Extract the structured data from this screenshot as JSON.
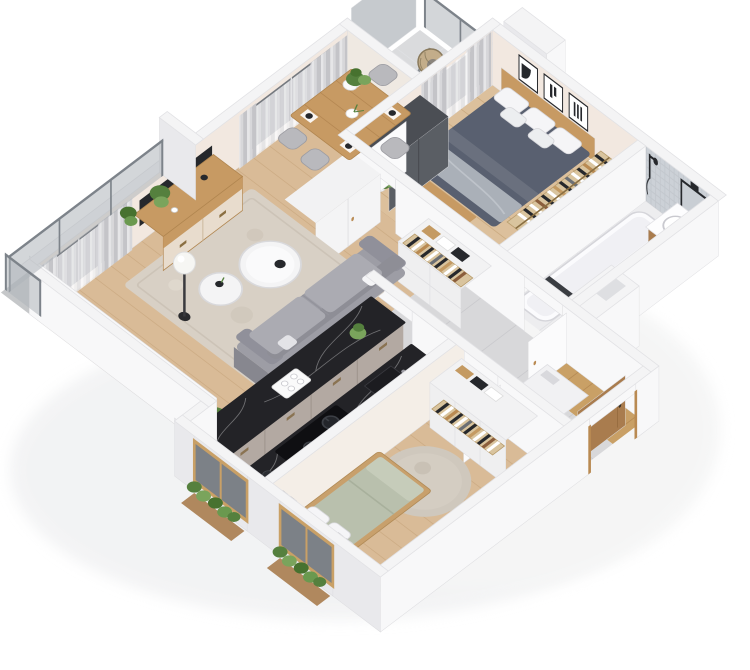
{
  "scene": {
    "type": "isometric-3d-floor-plan",
    "description": "3D isometric cutaway render of a two-bedroom apartment with open living/dining room, galley kitchen, two bedrooms, bathroom, hallway with storage, laundry nook, entry and two balconies",
    "background": "#ffffff"
  },
  "palette": {
    "background": "#ffffff",
    "wallTop": "#f4f4f5",
    "wallBright": "#f8f8f9",
    "wallShade": "#e9e9ec",
    "wallCream": "#f2e8e0",
    "wallCream2": "#f4eee7",
    "woodFloor": "#d9bb97",
    "woodFloor2": "#dcc09c",
    "tileFloor": "#d8d8da",
    "bathFloor": "#ededef",
    "balconyFloor": "#c5c7c9",
    "recessFloor": "#dadbdd",
    "entryWood": "#c9a066",
    "rugBeige": "#d8d0c5",
    "rugRound": "#cfc8bd",
    "marbleTop": "#232327",
    "cabinetFront": "#b3a9a2",
    "cabinetEnd": "#a69c95",
    "woodFurniture": "#c79a63",
    "sideboardFront": "#e8dccd",
    "sofaGray": "#9d9da5",
    "sofaBack": "#8e8e96",
    "sofaCushion": "#ababb2",
    "sofaFront": "#87878f",
    "bedDuvetDark": "#596070",
    "throwGray": "#aab0b8",
    "bedDuvetSage": "#b9c0ad",
    "pillowWhite": "#f5f5f7",
    "mosaicTile": "#ccd1d7",
    "plantDark": "#55803e",
    "plantLight": "#7aa45c",
    "potWhite": "#fafafa",
    "curtainGray": "#c9c9cd",
    "curtainSheer": "#ececee",
    "windowGlass": "#75797f",
    "frameBlack": "#26282c",
    "mirrorGlass": "#c9ced4",
    "applianceWhite": "#f7f7f9",
    "applianceDark": "#2e2e33",
    "glassRailing": "#aeb4ba",
    "doorLeaf": "#fbfbfc",
    "doorWood": "#a97c4e",
    "wardrobeDark": "#5a5e64",
    "wardrobeDarkTop": "#4b4e54",
    "closetWhite": "#f2f2f3",
    "cooktopBlack": "#0f0f12",
    "railWood": "#d9c49e",
    "hangerChair": "#c3ad8a"
  },
  "rooms": {
    "living_dining": {
      "label": "Living and dining room",
      "floor": "wood planks",
      "items": [
        "curtained windows",
        "sheer and gray drapes",
        "wall clock",
        "flat TV leaning on wall",
        "wooden sideboard with white drawers",
        "dining table",
        "four gray dining chairs",
        "place settings with dark plates",
        "white vase with flowers",
        "potted plant",
        "speckled beige area rug",
        "two round white coffee tables",
        "black decor bowl",
        "white globe floor lamp",
        "gray sofa with white throw pillows",
        "green floor plant"
      ]
    },
    "bedroom_1": {
      "label": "Main bedroom",
      "floor": "wood planks",
      "items": [
        "double bed with dark slate duvet",
        "white pillows",
        "gray throw blanket",
        "wooden headboard and foot bench",
        "three black-framed artworks",
        "open clothes rack with hangers",
        "dark gray wardrobe",
        "window to loggia with curtains",
        "potted plant",
        "white door leaf"
      ]
    },
    "bathroom": {
      "label": "Bathroom",
      "floor": "white stone tiles",
      "items": [
        "long bathtub",
        "black shower fixture",
        "gray mosaic tiled walls",
        "black framed mirror",
        "wall lamp",
        "wooden vanity with round washbasin",
        "dark towel",
        "open white door"
      ]
    },
    "hallway": {
      "label": "Hallway",
      "floor": "large gray tiles",
      "items": [
        "white storage cabinet",
        "closet with folded clothes",
        "open hanger rail with clothes",
        "doorways to rooms"
      ]
    },
    "entry": {
      "label": "Entry",
      "floor": "wood",
      "items": [
        "open wooden entry door",
        "floor niche"
      ]
    },
    "utility": {
      "label": "Laundry nook",
      "items": [
        "front-load washing machine",
        "white cabinets"
      ]
    },
    "kitchen": {
      "label": "Kitchen",
      "floor": "large light tiles",
      "items": [
        "peninsula counter with black marble top",
        "taupe drawer fronts",
        "second counter with black marble top",
        "black cooktop with two pots",
        "inset sink",
        "small green plant",
        "white cups and tray",
        "wooden window with planter"
      ]
    },
    "bedroom_2": {
      "label": "Second bedroom",
      "floor": "wood planks",
      "items": [
        "single bed with sage duvet",
        "white pillows",
        "wooden bed frame",
        "wardrobe with hanger rail and clothes",
        "round beige rug",
        "wooden window with curtains",
        "potted plant"
      ]
    },
    "balcony_left": {
      "label": "Left balcony",
      "items": [
        "glass railing with posts",
        "green plants",
        "white side wall"
      ]
    },
    "balcony_top": {
      "label": "Loggia balcony",
      "items": [
        "rattan hanging chair",
        "glass railing",
        "tall glass privacy panel",
        "potted plant"
      ]
    }
  }
}
